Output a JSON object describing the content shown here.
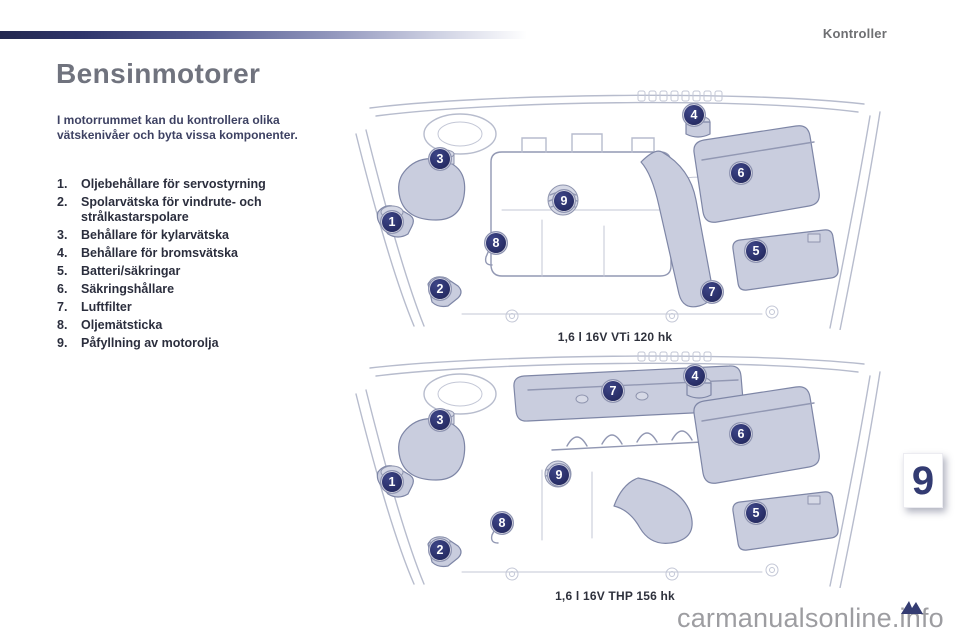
{
  "header": {
    "section_label": "Kontroller"
  },
  "page_title": "Bensinmotorer",
  "intro_text": "I motorrummet kan du kontrollera olika vätskenivåer och byta vissa komponenter.",
  "legend": {
    "items": [
      {
        "num": "1.",
        "label": "Oljebehållare för servostyrning"
      },
      {
        "num": "2.",
        "label": "Spolarvätska för vindrute- och strålkastarspolare"
      },
      {
        "num": "3.",
        "label": "Behållare för kylarvätska"
      },
      {
        "num": "4.",
        "label": "Behållare för bromsvätska"
      },
      {
        "num": "5.",
        "label": "Batteri/säkringar"
      },
      {
        "num": "6.",
        "label": "Säkringshållare"
      },
      {
        "num": "7.",
        "label": "Luftfilter"
      },
      {
        "num": "8.",
        "label": "Oljemätsticka"
      },
      {
        "num": "9.",
        "label": "Påfyllning av motorolja"
      }
    ]
  },
  "diagrams": [
    {
      "id": "engine-16v-vti",
      "caption": "1,6 l 16V VTi 120 hk",
      "callouts": [
        {
          "n": "1",
          "x": 49,
          "y": 133
        },
        {
          "n": "2",
          "x": 97,
          "y": 200
        },
        {
          "n": "3",
          "x": 97,
          "y": 70
        },
        {
          "n": "4",
          "x": 351,
          "y": 26
        },
        {
          "n": "5",
          "x": 413,
          "y": 162
        },
        {
          "n": "6",
          "x": 398,
          "y": 84
        },
        {
          "n": "7",
          "x": 369,
          "y": 203
        },
        {
          "n": "8",
          "x": 153,
          "y": 154
        },
        {
          "n": "9",
          "x": 221,
          "y": 112
        }
      ]
    },
    {
      "id": "engine-16v-thp",
      "caption": "1,6 l 16V THP 156 hk",
      "callouts": [
        {
          "n": "1",
          "x": 49,
          "y": 131
        },
        {
          "n": "2",
          "x": 97,
          "y": 199
        },
        {
          "n": "3",
          "x": 97,
          "y": 69
        },
        {
          "n": "4",
          "x": 352,
          "y": 25
        },
        {
          "n": "5",
          "x": 413,
          "y": 162
        },
        {
          "n": "6",
          "x": 398,
          "y": 83
        },
        {
          "n": "7",
          "x": 270,
          "y": 40
        },
        {
          "n": "8",
          "x": 159,
          "y": 172
        },
        {
          "n": "9",
          "x": 216,
          "y": 124
        }
      ]
    }
  ],
  "chapter_tab": {
    "number": "9"
  },
  "watermark": {
    "text": "carmanualsonline.info"
  },
  "colors": {
    "accent_navy": "#2b316b",
    "title_gray": "#70737e",
    "section_gray": "#6e6f72",
    "body_text": "#2b2e3d",
    "intro_text": "#3e4263",
    "part_fill": "#c9cdde",
    "watermark_gray": "#9d9da1"
  }
}
